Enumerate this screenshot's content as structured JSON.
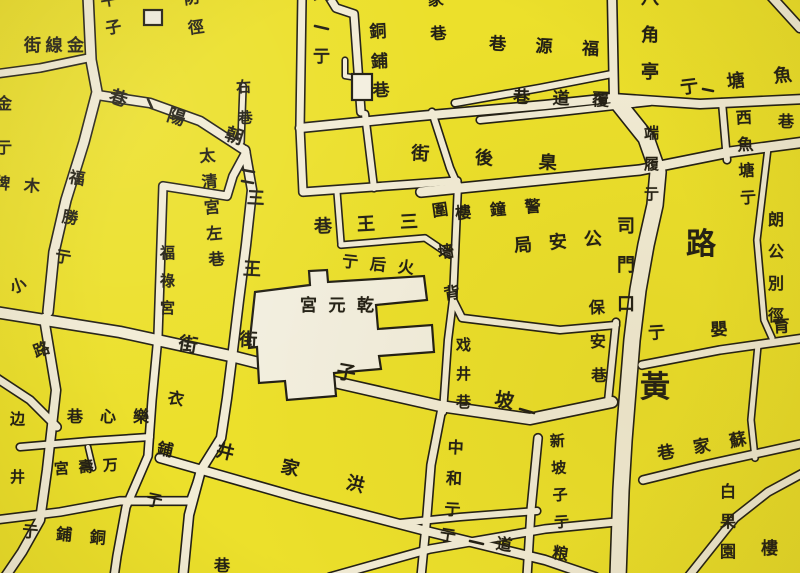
{
  "map": {
    "type": "historical-street-map",
    "language": "zh-Hant",
    "colors": {
      "background": "#ece02b",
      "road_fill": "#f2ecd6",
      "ink": "#221f15",
      "building_fill": "#f3efdf"
    },
    "landmarks": [
      {
        "name": "乾元宮",
        "kind": "temple-compound"
      },
      {
        "name": "公安局",
        "kind": "government"
      },
      {
        "name": "警鐘樓",
        "kind": "tower"
      },
      {
        "name": "万壽宮",
        "kind": "temple"
      },
      {
        "name": "福祿宮",
        "kind": "temple"
      }
    ],
    "street_names_visible": [
      "金線街",
      "平子",
      "防徑",
      "興亍",
      "家巷",
      "銅鋪巷",
      "魚塘亍",
      "福源巷",
      "八角亭",
      "覆道巷",
      "西魚塘亍",
      "巷",
      "右巷",
      "朝陽巷",
      "太清宮左巷",
      "三王街",
      "三王巷",
      "火后亍",
      "乾元宮",
      "臬後街",
      "警鐘樓",
      "公安局",
      "圍墻背",
      "司門口",
      "保安巷",
      "朗公別徑",
      "端履亍",
      "路",
      "黃",
      "育嬰亍",
      "戏井巷",
      "坡子街",
      "洪家井",
      "中和亍",
      "新坡子亍",
      "蘇家巷",
      "白果園",
      "樓",
      "粮道亍",
      "樂心巷",
      "万壽宮",
      "边",
      "井",
      "銅鋪亍",
      "衣鋪亍",
      "福勝亍",
      "小路",
      "金亍",
      "福祿宮",
      "木牌"
    ],
    "labels": [
      {
        "id": "jinxianjie",
        "t": "金線街",
        "o": "h",
        "x": 24,
        "y": 38,
        "w": 60,
        "s": 17,
        "r": 0
      },
      {
        "id": "pingzi",
        "t": "平子",
        "o": "v",
        "x": 101,
        "y": -8,
        "h": 44,
        "s": 16,
        "r": -10,
        "clipped": true
      },
      {
        "id": "fangjing",
        "t": "防徑",
        "o": "v",
        "x": 184,
        "y": -10,
        "h": 46,
        "s": 16,
        "r": -8,
        "clipped": true
      },
      {
        "id": "xingjie",
        "t": "興亍",
        "o": "v",
        "x": 311,
        "y": -14,
        "h": 80,
        "s": 17,
        "r": 0,
        "clipped": true
      },
      {
        "id": "jiaxiang",
        "t": "家巷",
        "o": "v",
        "x": 427,
        "y": -8,
        "h": 50,
        "s": 16,
        "r": -5,
        "clipped": true
      },
      {
        "id": "tongpuxiang",
        "t": "銅鋪巷",
        "o": "v",
        "x": 369,
        "y": 24,
        "h": 76,
        "s": 17,
        "r": -3
      },
      {
        "id": "yutangjie",
        "t": "魚塘亍",
        "o": "h",
        "x": 680,
        "y": 73,
        "w": 112,
        "s": 18,
        "r": -7
      },
      {
        "id": "fuyuanxiang",
        "t": "福源巷",
        "o": "h",
        "x": 489,
        "y": 39,
        "w": 110,
        "s": 17,
        "r": 3
      },
      {
        "id": "bajiaoting",
        "t": "八角亭",
        "o": "v",
        "x": 639,
        "y": -10,
        "h": 92,
        "s": 18,
        "r": 0,
        "clipped": true
      },
      {
        "id": "fudaoxiang",
        "t": "覆道巷",
        "o": "h",
        "x": 513,
        "y": 91,
        "w": 96,
        "s": 17,
        "r": 2
      },
      {
        "id": "xiyutangjie",
        "t": "西魚塘亍",
        "o": "v",
        "x": 736,
        "y": 110,
        "h": 96,
        "s": 16,
        "r": -3
      },
      {
        "id": "xiang-right",
        "t": "巷",
        "o": "h",
        "x": 778,
        "y": 114,
        "s": 16,
        "clipped": true
      },
      {
        "id": "youxiang",
        "t": "右巷",
        "o": "v",
        "x": 235,
        "y": 80,
        "h": 46,
        "s": 15,
        "r": -3
      },
      {
        "id": "chaoyangxiang",
        "t": "朝陽巷",
        "o": "h",
        "x": 106,
        "y": 109,
        "w": 140,
        "s": 18,
        "r": 18
      },
      {
        "id": "taiqinggongzuoxiang",
        "t": "太清宮左巷",
        "o": "v",
        "x": 202,
        "y": 148,
        "h": 120,
        "s": 16,
        "r": -5
      },
      {
        "id": "sanwangjie",
        "t": "三王街",
        "o": "v",
        "x": 241,
        "y": 190,
        "h": 160,
        "s": 18,
        "r": 3
      },
      {
        "id": "sanwangxiang",
        "t": "三王巷",
        "o": "h",
        "x": 314,
        "y": 216,
        "w": 104,
        "s": 18,
        "r": -3
      },
      {
        "id": "huohoujie",
        "t": "火后亍",
        "o": "h",
        "x": 342,
        "y": 257,
        "w": 72,
        "s": 16,
        "r": 6
      },
      {
        "id": "qianyuangong",
        "t": "乾元宮",
        "o": "h",
        "x": 300,
        "y": 298,
        "w": 74,
        "s": 17,
        "r": 0
      },
      {
        "id": "niehoujie",
        "t": "臬後街",
        "o": "h",
        "x": 411,
        "y": 150,
        "w": 146,
        "s": 18,
        "r": 4
      },
      {
        "id": "jingzhonglou",
        "t": "警鐘樓",
        "o": "h",
        "x": 455,
        "y": 202,
        "w": 86,
        "s": 16,
        "r": -5
      },
      {
        "id": "gonganju",
        "t": "公安局",
        "o": "h",
        "x": 514,
        "y": 234,
        "w": 88,
        "s": 18,
        "r": -5
      },
      {
        "id": "weiqiangbei",
        "t": "圍墻背",
        "o": "v",
        "x": 436,
        "y": 202,
        "h": 100,
        "s": 16,
        "r": -8
      },
      {
        "id": "simenkou",
        "t": "司門口",
        "o": "v",
        "x": 615,
        "y": 218,
        "h": 96,
        "s": 18,
        "r": 0
      },
      {
        "id": "baoanxiang",
        "t": "保安巷",
        "o": "v",
        "x": 588,
        "y": 300,
        "h": 84,
        "s": 16,
        "r": -2
      },
      {
        "id": "langgongbiejing",
        "t": "朗公別徑",
        "o": "v",
        "x": 766,
        "y": 212,
        "h": 112,
        "s": 16,
        "r": 0
      },
      {
        "id": "duanlvjie",
        "t": "端履亍",
        "o": "v",
        "x": 642,
        "y": 126,
        "h": 76,
        "s": 15,
        "r": 0
      },
      {
        "id": "lu-big",
        "t": "路",
        "o": "h",
        "x": 686,
        "y": 230,
        "s": 30
      },
      {
        "id": "huang-big",
        "t": "黃",
        "o": "h",
        "x": 640,
        "y": 373,
        "s": 30
      },
      {
        "id": "yuyingjie",
        "t": "育嬰亍",
        "o": "h",
        "x": 648,
        "y": 322,
        "w": 142,
        "s": 17,
        "r": -3
      },
      {
        "id": "xijingxiang",
        "t": "戏井巷",
        "o": "v",
        "x": 454,
        "y": 338,
        "h": 72,
        "s": 15,
        "r": 0
      },
      {
        "id": "pozijie",
        "t": "坡子街",
        "o": "h",
        "x": 176,
        "y": 364,
        "w": 340,
        "s": 19,
        "r": 10
      },
      {
        "id": "hongjiajing",
        "t": "洪家井",
        "o": "h",
        "x": 214,
        "y": 460,
        "w": 152,
        "s": 18,
        "r": 14
      },
      {
        "id": "zhonghejie",
        "t": "中和亍",
        "o": "v",
        "x": 444,
        "y": 440,
        "h": 78,
        "s": 16,
        "r": 3
      },
      {
        "id": "xinpozijie",
        "t": "新坡子亍",
        "o": "v",
        "x": 550,
        "y": 434,
        "h": 96,
        "s": 15,
        "r": -3
      },
      {
        "id": "sujiaxiang",
        "t": "蘇家巷",
        "o": "h",
        "x": 657,
        "y": 439,
        "w": 90,
        "s": 17,
        "r": -10
      },
      {
        "id": "baiguoyuan",
        "t": "白果園",
        "o": "v",
        "x": 718,
        "y": 484,
        "h": 76,
        "s": 16,
        "r": 0
      },
      {
        "id": "lou-partial",
        "t": "樓",
        "o": "h",
        "x": 761,
        "y": 541,
        "s": 17,
        "clipped": true
      },
      {
        "id": "liangdaojie",
        "t": "粮道亍",
        "o": "h",
        "x": 439,
        "y": 537,
        "w": 130,
        "s": 16,
        "r": 9
      },
      {
        "id": "xiang-bottom",
        "t": "巷",
        "o": "h",
        "x": 214,
        "y": 558,
        "s": 16,
        "clipped": true
      },
      {
        "id": "lexinxiang",
        "t": "樂心巷",
        "o": "h",
        "x": 67,
        "y": 409,
        "w": 82,
        "s": 16,
        "r": 0
      },
      {
        "id": "wanshougong",
        "t": "万壽宮",
        "o": "h",
        "x": 54,
        "y": 460,
        "w": 64,
        "s": 15,
        "r": -4
      },
      {
        "id": "bian",
        "t": "边",
        "o": "h",
        "x": 10,
        "y": 412,
        "s": 15,
        "clipped": true
      },
      {
        "id": "jing-left",
        "t": "井",
        "o": "h",
        "x": 10,
        "y": 470,
        "s": 15,
        "clipped": true
      },
      {
        "id": "tongpujie",
        "t": "銅鋪亍",
        "o": "h",
        "x": 22,
        "y": 527,
        "w": 84,
        "s": 16,
        "r": 5
      },
      {
        "id": "yipujie",
        "t": "衣鋪亍",
        "o": "v",
        "x": 155,
        "y": 390,
        "h": 120,
        "s": 16,
        "r": 12
      },
      {
        "id": "fushengjie",
        "t": "福勝亍",
        "o": "v",
        "x": 60,
        "y": 170,
        "h": 96,
        "s": 16,
        "r": 10
      },
      {
        "id": "xiaolu",
        "t": "小路",
        "o": "v",
        "x": 20,
        "y": 276,
        "h": 84,
        "s": 16,
        "r": -20
      },
      {
        "id": "jinjie-left",
        "t": "金亍",
        "o": "v",
        "x": -6,
        "y": 96,
        "h": 60,
        "s": 16,
        "clipped": true
      },
      {
        "id": "fulugong",
        "t": "福祿宮",
        "o": "v",
        "x": 158,
        "y": 246,
        "h": 70,
        "s": 15,
        "r": 0
      },
      {
        "id": "mupai",
        "t": "木牌",
        "o": "h",
        "x": -6,
        "y": 177,
        "w": 46,
        "s": 16,
        "r": 5,
        "clipped": true
      }
    ]
  }
}
